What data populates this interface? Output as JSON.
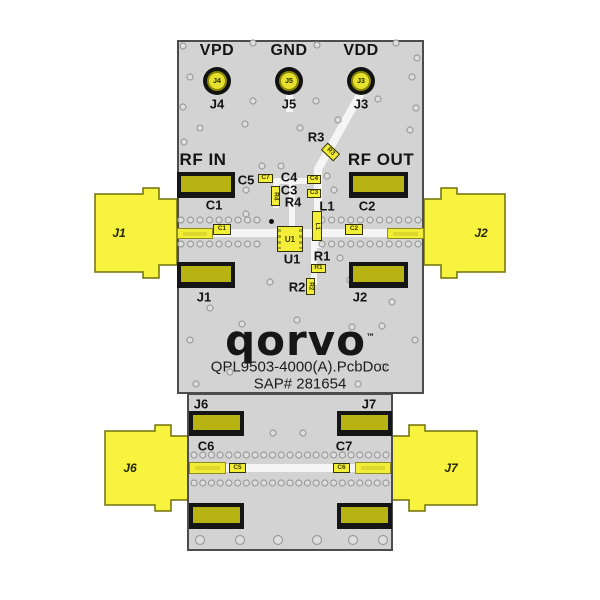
{
  "board": {
    "logo": "qorvo",
    "logo_tm": "™",
    "title": "QPL9503-4000(A).PcbDoc",
    "sap": "SAP# 281654"
  },
  "test_points": [
    {
      "label": "VPD",
      "pin": "J4",
      "silk": "J4"
    },
    {
      "label": "GND",
      "pin": "J5",
      "silk": "J5"
    },
    {
      "label": "VDD",
      "pin": "J3",
      "silk": "J3"
    }
  ],
  "rf": {
    "in": "RF IN",
    "out": "RF OUT"
  },
  "silk": {
    "c1": "C1",
    "c2": "C2",
    "c3": "C3",
    "c4": "C4",
    "c5": "C5",
    "c6": "C6",
    "c7": "C7",
    "r1": "R1",
    "r2": "R2",
    "r3": "R3",
    "r4": "R4",
    "l1": "L1",
    "u1": "U1",
    "j1": "J1",
    "j2": "J2",
    "j6": "J6",
    "j7": "J7"
  },
  "chips": {
    "c1": "C1",
    "c2": "C2",
    "c3": "C3",
    "c4": "C4",
    "c5": "C7",
    "c6": "C5",
    "c7": "C6",
    "r1": "R1",
    "r2": "R2",
    "r3": "R3",
    "r4": "R4",
    "l1": "L1",
    "u1": "U1"
  },
  "connectors": {
    "j1": "J1",
    "j2": "J2",
    "j6": "J6",
    "j7": "J7"
  },
  "colors": {
    "connector_yellow": "#f7f33e",
    "pad_olive": "#b7b312",
    "board_gray": "#d3d3d3",
    "pad_black": "#151515",
    "trace_white": "#f5f5f5",
    "silk_black": "#141414"
  }
}
